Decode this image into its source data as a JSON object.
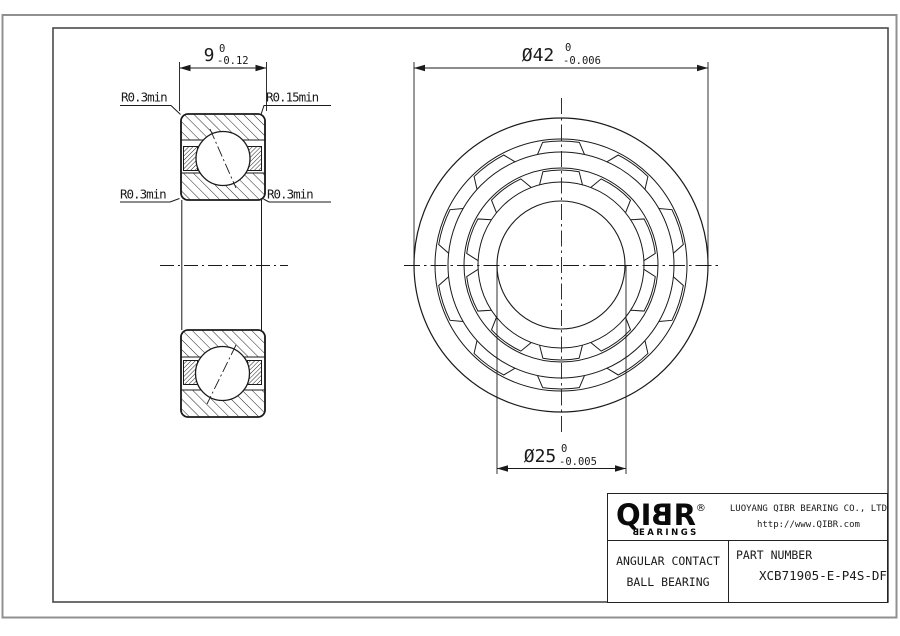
{
  "drawing": {
    "section_view": {
      "width_dim": {
        "value": "9",
        "tol_upper": "0",
        "tol_lower": "-0.12"
      },
      "radius_labels": {
        "top_left": "R0.3min",
        "top_right": "R0.15min",
        "mid_left": "R0.3min",
        "mid_right": "R0.3min"
      }
    },
    "front_view": {
      "outer_diameter": {
        "value": "Ø42",
        "tol_upper": "0",
        "tol_lower": "-0.006"
      },
      "bore_diameter": {
        "value": "Ø25",
        "tol_upper": "0",
        "tol_lower": "-0.005"
      }
    }
  },
  "title_block": {
    "logo": {
      "part_qi": "QI",
      "part_b": "B",
      "part_r": "R",
      "reg": "®",
      "sub_b": "B",
      "sub_rest": "EARINGS"
    },
    "company": "LUOYANG QIBR BEARING CO., LTD",
    "website": "http://www.QIBR.com",
    "product_line1": "ANGULAR CONTACT",
    "product_line2": "BALL BEARING",
    "part_number_label": "PART NUMBER",
    "part_number": "XCB71905-E-P4S-DF"
  },
  "colors": {
    "line": "#1a1a1a",
    "frame_outer": "#909090",
    "frame_inner": "#4a4a4a"
  }
}
